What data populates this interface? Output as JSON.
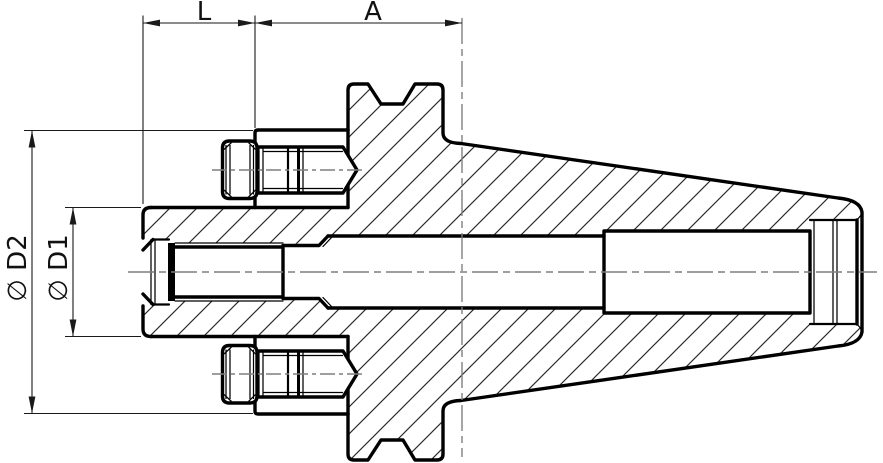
{
  "drawing": {
    "title": "Tool holder cross-section drawing",
    "dimensions": {
      "l": "L",
      "a": "A",
      "d2": "∅ D2",
      "d1": "∅ D1"
    },
    "colors": {
      "line": "#000000",
      "hatch": "#2a2a2a",
      "centerline": "#7f7f7f",
      "background": "#ffffff"
    }
  }
}
